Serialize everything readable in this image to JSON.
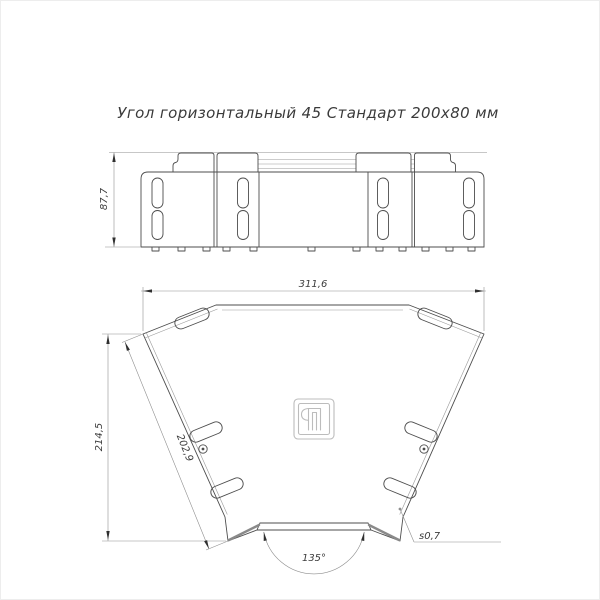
{
  "title": "Угол горизонтальный 45 Стандарт 200x80 мм",
  "dimensions": {
    "side_height": "87,7",
    "plan_width": "311,6",
    "plan_height": "214,5",
    "side_length": "202,9",
    "angle": "135°",
    "thickness": "s0,7"
  },
  "colors": {
    "line": "#4d4d4d",
    "light_line": "#9a9a9a",
    "dim_line": "#8f8f8f",
    "text": "#3c3c3c",
    "logo": "#bcbcbc",
    "background": "#ffffff"
  }
}
